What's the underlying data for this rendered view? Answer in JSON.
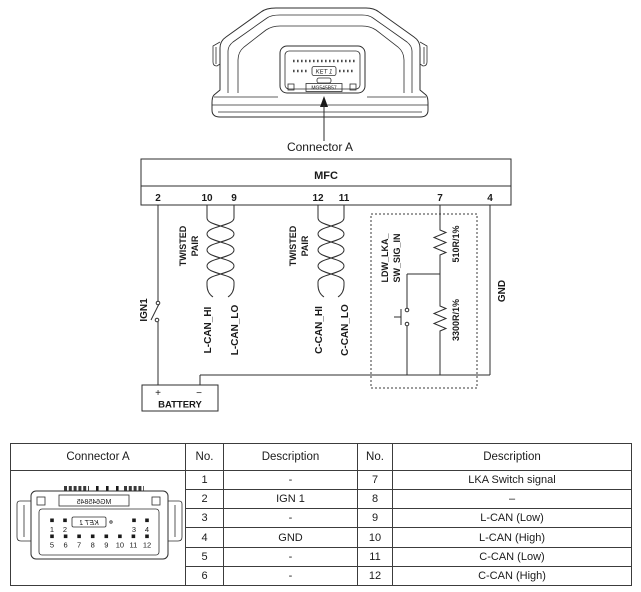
{
  "figure": {
    "caption": "Connector A",
    "device": {
      "ket_label": "KET 1",
      "part_number": "MG545B57"
    }
  },
  "schematic": {
    "title": "MFC",
    "pins": [
      "2",
      "10",
      "9",
      "12",
      "11",
      "7",
      "4"
    ],
    "labels": {
      "ign": "IGN1",
      "twisted1": "TWISTED",
      "twisted2": "PAIR",
      "lcan_hi": "L-CAN_HI",
      "lcan_lo": "L-CAN_LO",
      "ccan_hi": "C-CAN_HI",
      "ccan_lo": "C-CAN_LO",
      "ldw1": "LDW_LKA_",
      "ldw2": "SW_SIG_IN",
      "r_top": "510R/1%",
      "r_bottom": "3300R/1%",
      "gnd": "GND",
      "battery": "BATTERY",
      "plus": "+",
      "minus": "−"
    }
  },
  "table": {
    "headers": [
      "Connector A",
      "No.",
      "Description",
      "No.",
      "Description"
    ],
    "rows": [
      {
        "no_l": "1",
        "desc_l": "-",
        "no_r": "7",
        "desc_r": "LKA Switch signal"
      },
      {
        "no_l": "2",
        "desc_l": "IGN 1",
        "no_r": "8",
        "desc_r": "–"
      },
      {
        "no_l": "3",
        "desc_l": "-",
        "no_r": "9",
        "desc_r": "L-CAN (Low)"
      },
      {
        "no_l": "4",
        "desc_l": "GND",
        "no_r": "10",
        "desc_r": "L-CAN (High)"
      },
      {
        "no_l": "5",
        "desc_l": "-",
        "no_r": "11",
        "desc_r": "C-CAN (Low)"
      },
      {
        "no_l": "6",
        "desc_l": "-",
        "no_r": "12",
        "desc_r": "C-CAN (High)"
      }
    ],
    "connector_drawing": {
      "part_number": "MG645845",
      "ket_label": "KET 1",
      "top_pins": [
        "1",
        "2",
        "3",
        "4"
      ],
      "bottom_pins": [
        "5",
        "6",
        "7",
        "8",
        "9",
        "10",
        "11",
        "12"
      ]
    }
  }
}
